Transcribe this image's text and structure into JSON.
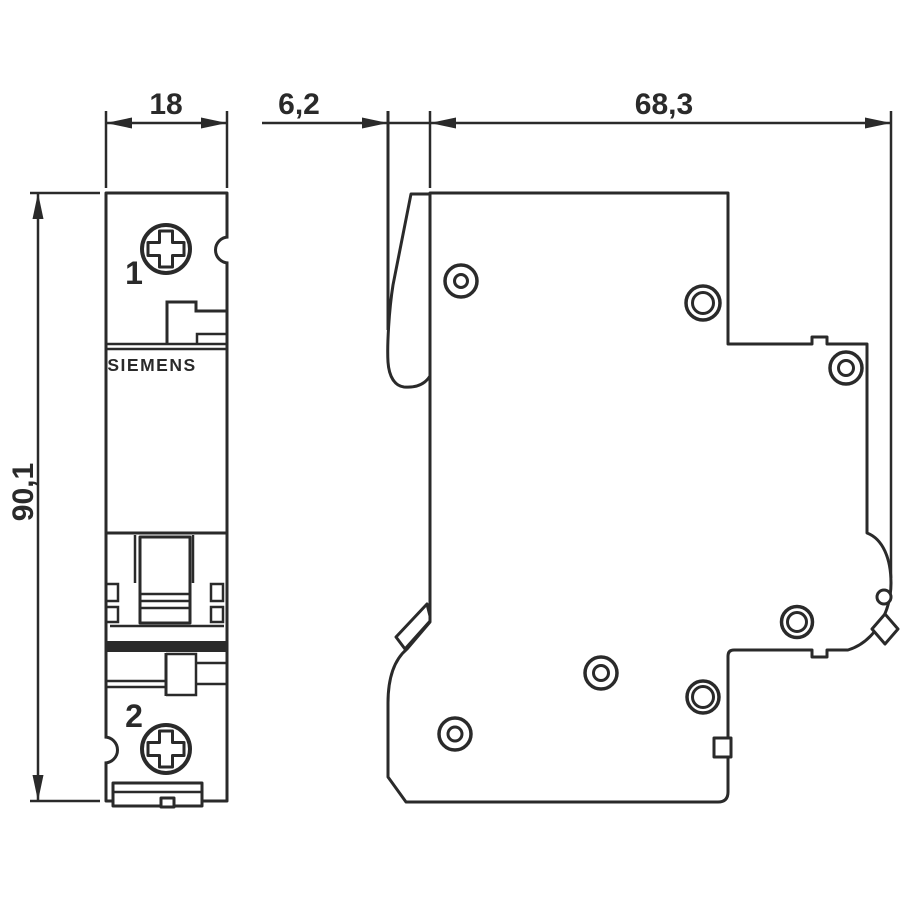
{
  "colors": {
    "background": "#ffffff",
    "line": "#2a2a2a"
  },
  "drawing": {
    "brand_label": "SIEMENS",
    "terminal_top_label": "1",
    "terminal_bottom_label": "2",
    "dim_width": "18",
    "dim_handle_projection": "6,2",
    "dim_depth": "68,3",
    "dim_height": "90,1"
  }
}
